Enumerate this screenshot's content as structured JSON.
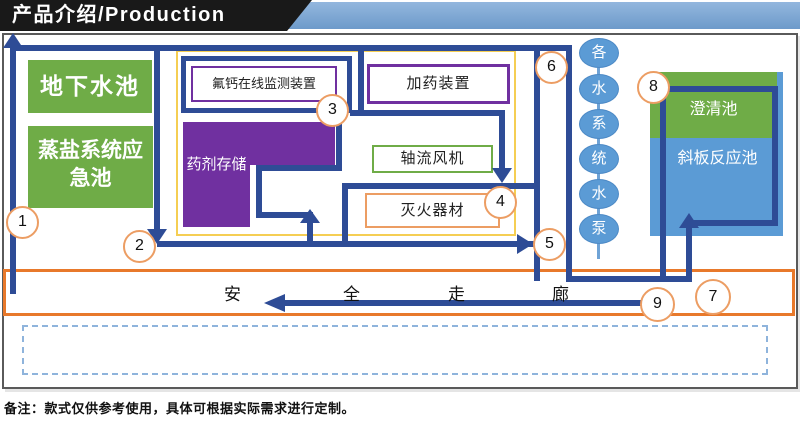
{
  "banner": {
    "title": "产品介绍/Production"
  },
  "facility": {
    "underground_pool": "地下水池",
    "salt_emergency_pool": "蒸盐系统应急池",
    "fluoride_monitor": "氟钙在线监测装置",
    "dosing_device": "加药装置",
    "chemical_storage": "药剂存储",
    "axial_fan": "轴流风机",
    "fire_equipment": "灭火器材",
    "clarifier": "澄清池",
    "inclined_plate_reactor": "斜板反应池"
  },
  "pump_column": {
    "label": "各水系统水泵",
    "chars": [
      "各",
      "水",
      "系",
      "统",
      "水",
      "泵"
    ]
  },
  "corridor": {
    "label": "安全走廊",
    "chars": [
      "安",
      "全",
      "走",
      "廊"
    ]
  },
  "route_markers": [
    "1",
    "2",
    "3",
    "4",
    "5",
    "6",
    "7",
    "8",
    "9"
  ],
  "note": "备注：款式仅供参考使用，具体可根据实际需求进行定制。",
  "colors": {
    "path_navy": "#2e4c96",
    "green": "#6fac47",
    "purple": "#7030a0",
    "pool_blue": "#5b9bd5",
    "corridor_orange": "#e8792b",
    "zone_yellow": "#f5ce53",
    "marker_orange": "#ec9d63",
    "banner_blue": "#7ba4d2"
  }
}
